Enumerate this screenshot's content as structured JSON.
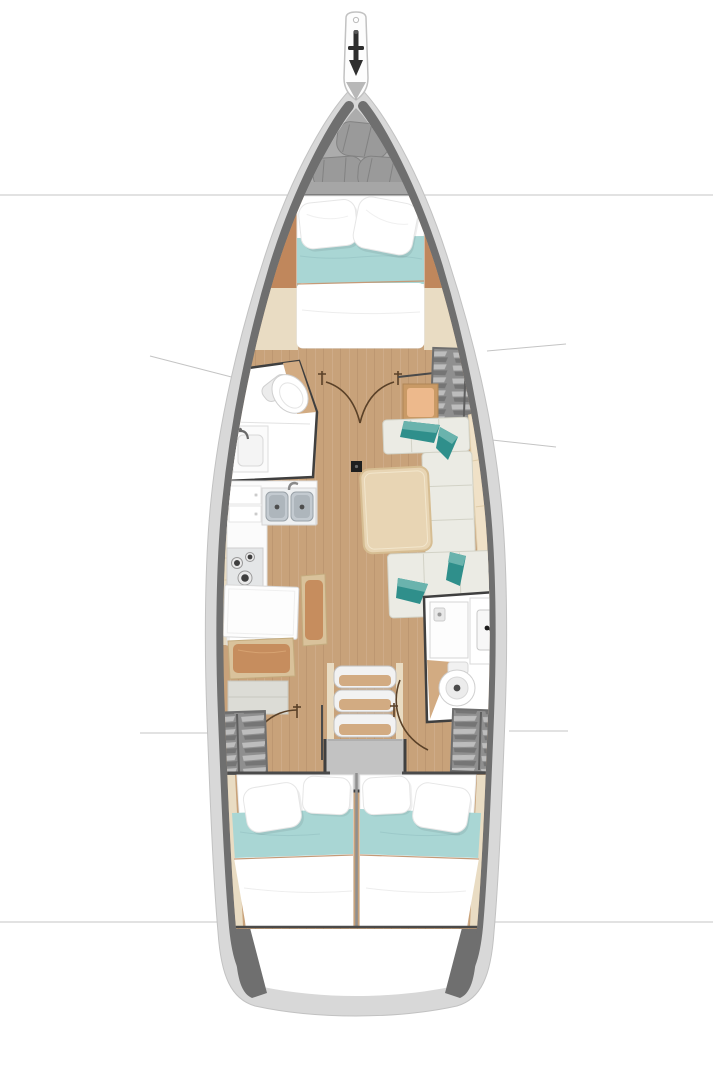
{
  "document": {
    "title": "Sailing yacht interior layout — top-down deck plan",
    "view": "overhead floor plan",
    "orientation": "bow at top, stern at bottom"
  },
  "colors": {
    "bg": "#ffffff",
    "hullBand": "#d8d8d8",
    "hullEdge": "#c2c2c2",
    "hullDark": "#6f6f6f",
    "lockerGray": "#acacac",
    "sailGray": "#9a9a9a",
    "sailEdge": "#828282",
    "barGray": "#a6a6a6",
    "woodFloor": "#c8a27a",
    "woodFloorLight": "#d2ab82",
    "woodPanel": "#e9dcc3",
    "woodPanelSeam": "#d8c7a6",
    "woodTan": "#c0875c",
    "seatBrown": "#c68d5e",
    "seatRim": "#d9c29b",
    "peach": "#edb98c",
    "peachRim": "#c99a66",
    "teal": "#a9d6d4",
    "tealPiping": "#c59a78",
    "tealPillow": "#2f8f8b",
    "tealPillowLight": "#6ab3ad",
    "cushion": "#ebebe4",
    "cushionSeam": "#d2d2c6",
    "setteeBack": "#f0e1c7",
    "table": "#e8d5b4",
    "tableEdge": "#d6bd92",
    "white": "#ffffff",
    "fixtureStroke": "#cfcfcf",
    "steel": "#c3cad0",
    "steelDark": "#9aa2a8",
    "basinFill": "#aeb6bc",
    "burner": "#3f3f3f",
    "stove": "#e4e6e7",
    "wall": "#3f3f3f",
    "platform": "#c2c2c2",
    "steps": "#f2f2f2",
    "stepEdge": "#c2c2c2",
    "doorArc": "#5a4128",
    "refLine": "#c4c4c4",
    "grayBench": "#dcdcd6",
    "navDesk": "#fdfdfd",
    "divider": "#8f8f8f",
    "anchorDark": "#2e2e2e",
    "clothesLight": "#bdbdbd",
    "clothesDark": "#757575",
    "wardrobe": "#8f8f8f",
    "pillowEdge": "#e6e6e6",
    "duvetFold": "#ededed"
  },
  "plan": {
    "zones": [
      {
        "id": "bow-fitting",
        "label": "Anchor and bow fitting"
      },
      {
        "id": "sail-locker",
        "label": "Forepeak sail locker with 3 stowed sails"
      },
      {
        "id": "forward-cabin",
        "label": "Forward cabin with double berth, pillows and teal runner"
      },
      {
        "id": "forward-head",
        "label": "Forward head with toilet and washbasin"
      },
      {
        "id": "saloon",
        "label": "Saloon with C-shaped settee, 4 teal pillows and dining table"
      },
      {
        "id": "galley",
        "label": "L-shaped galley with double sink, stove and cabinets"
      },
      {
        "id": "nav-station",
        "label": "Chart table with navigator seat"
      },
      {
        "id": "wardrobe-forward",
        "label": "Starboard hanging locker"
      },
      {
        "id": "aft-head",
        "label": "Aft head with shower, washbasin and toilet"
      },
      {
        "id": "companionway",
        "label": "Companionway with three steps and engine box"
      },
      {
        "id": "wardrobe-aft-port",
        "label": "Port aft hanging locker"
      },
      {
        "id": "wardrobe-aft-starboard",
        "label": "Starboard aft hanging locker"
      },
      {
        "id": "aft-cabin-port",
        "label": "Port aft cabin with double berth"
      },
      {
        "id": "aft-cabin-starboard",
        "label": "Starboard aft cabin with double berth"
      },
      {
        "id": "stern",
        "label": "Transom / stern platform"
      }
    ],
    "berth_count": 3,
    "head_count": 2,
    "mast_step": "black square forward of saloon table"
  }
}
